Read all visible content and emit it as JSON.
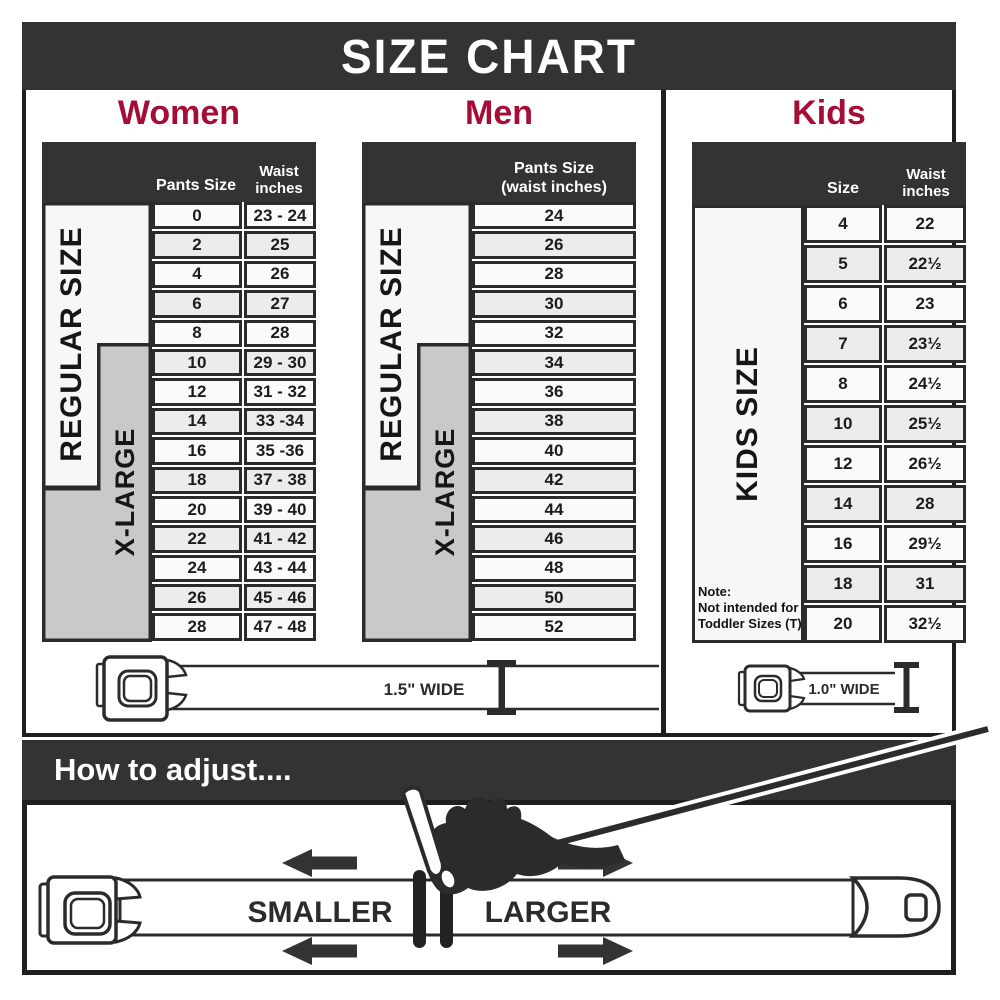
{
  "banner": {
    "title": "SIZE CHART"
  },
  "women": {
    "title": "Women",
    "headers": {
      "col1": "Pants Size",
      "col2_line1": "Waist",
      "col2_line2": "inches"
    },
    "zones": {
      "regular": "REGULAR SIZE",
      "xlarge": "X-LARGE"
    },
    "rows": [
      {
        "size": "0",
        "waist": "23 - 24"
      },
      {
        "size": "2",
        "waist": "25"
      },
      {
        "size": "4",
        "waist": "26"
      },
      {
        "size": "6",
        "waist": "27"
      },
      {
        "size": "8",
        "waist": "28"
      },
      {
        "size": "10",
        "waist": "29 - 30"
      },
      {
        "size": "12",
        "waist": "31 - 32"
      },
      {
        "size": "14",
        "waist": "33 -34"
      },
      {
        "size": "16",
        "waist": "35 -36"
      },
      {
        "size": "18",
        "waist": "37 - 38"
      },
      {
        "size": "20",
        "waist": "39 - 40"
      },
      {
        "size": "22",
        "waist": "41 - 42"
      },
      {
        "size": "24",
        "waist": "43 - 44"
      },
      {
        "size": "26",
        "waist": "45 - 46"
      },
      {
        "size": "28",
        "waist": "47 - 48"
      }
    ],
    "belt_width_label": "1.5\" WIDE"
  },
  "men": {
    "title": "Men",
    "headers": {
      "col_line1": "Pants Size",
      "col_line2": "(waist inches)"
    },
    "zones": {
      "regular": "REGULAR SIZE",
      "xlarge": "X-LARGE"
    },
    "rows": [
      "24",
      "26",
      "28",
      "30",
      "32",
      "34",
      "36",
      "38",
      "40",
      "42",
      "44",
      "46",
      "48",
      "50",
      "52"
    ]
  },
  "kids": {
    "title": "Kids",
    "headers": {
      "col1": "Size",
      "col2_line1": "Waist",
      "col2_line2": "inches"
    },
    "zone": "KIDS SIZE",
    "note": {
      "line1": "Note:",
      "line2": "Not intended for",
      "line3": "Toddler Sizes (T)"
    },
    "rows": [
      {
        "size": "4",
        "waist": "22"
      },
      {
        "size": "5",
        "waist": "22½"
      },
      {
        "size": "6",
        "waist": "23"
      },
      {
        "size": "7",
        "waist": "23½"
      },
      {
        "size": "8",
        "waist": "24½"
      },
      {
        "size": "10",
        "waist": "25½"
      },
      {
        "size": "12",
        "waist": "26½"
      },
      {
        "size": "14",
        "waist": "28"
      },
      {
        "size": "16",
        "waist": "29½"
      },
      {
        "size": "18",
        "waist": "31"
      },
      {
        "size": "20",
        "waist": "32½"
      }
    ],
    "belt_width_label": "1.0\" WIDE"
  },
  "how_to_adjust": {
    "title": "How to adjust....",
    "smaller_label": "SMALLER",
    "larger_label": "LARGER"
  },
  "colors": {
    "accent_red": "#a60d36",
    "header_dark": "#333333",
    "zone_gray": "#c9c9c9",
    "zone_white": "#f7f7f7",
    "row_light": "#fafafa",
    "row_alt": "#ececec",
    "line_dark": "#2b2b2b"
  }
}
